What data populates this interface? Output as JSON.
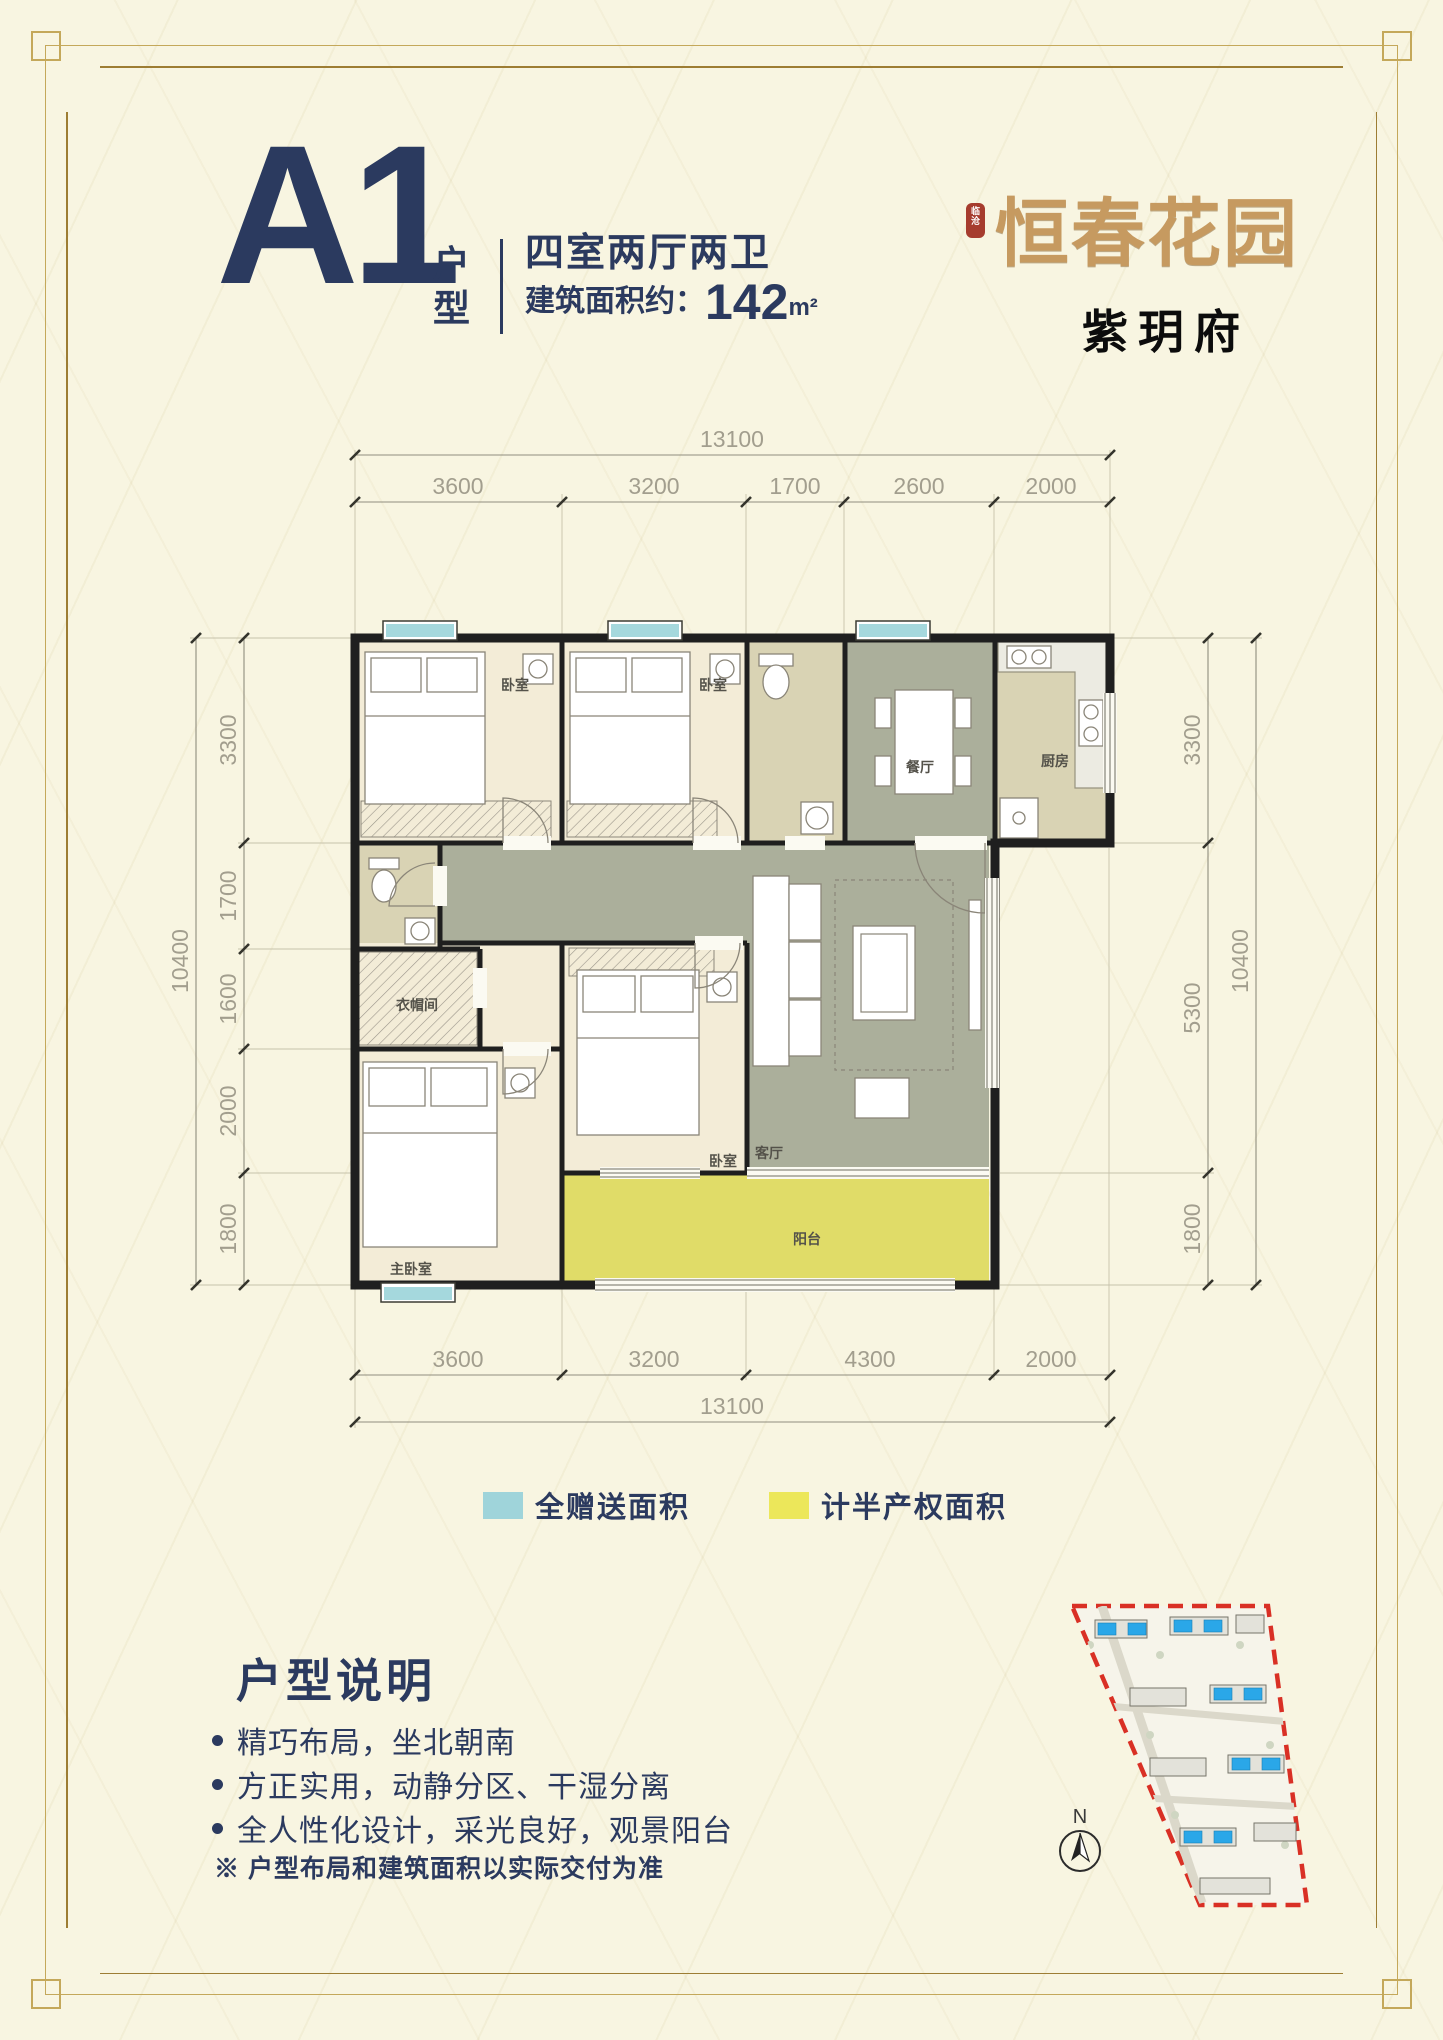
{
  "page": {
    "background": "#f8f5e1"
  },
  "header": {
    "plan_code": "A1",
    "plan_code_label": "户型",
    "spec": "四室两厅两卫",
    "area_label": "建筑面积约：",
    "area_value": "142",
    "area_unit": "m²"
  },
  "brand": {
    "seal": "临沧",
    "name": "恒春花园",
    "subname": "紫玥府"
  },
  "plan": {
    "dims": {
      "top_total": "13100",
      "top": [
        "3600",
        "3200",
        "1700",
        "2600",
        "2000"
      ],
      "left_total": "10400",
      "left": [
        "3300",
        "1700",
        "1600",
        "2000",
        "1800"
      ],
      "right_total": "10400",
      "right": [
        "3300",
        "5300",
        "1800"
      ],
      "bottom": [
        "3600",
        "3200",
        "4300",
        "2000"
      ],
      "bottom_total": "13100"
    },
    "rooms": {
      "bedroom": "卧室",
      "dining": "餐厅",
      "kitchen": "厨房",
      "closet": "衣帽间",
      "living": "客厅",
      "master": "主卧室",
      "balcony": "阳台"
    }
  },
  "legend": {
    "items": [
      {
        "label": "全赠送面积",
        "color": "#9fd4da"
      },
      {
        "label": "计半产权面积",
        "color": "#ece75a"
      }
    ]
  },
  "notes": {
    "title": "户型说明",
    "bullets": [
      "精巧布局，坐北朝南",
      "方正实用，动静分区、干湿分离",
      "全人性化设计，采光良好，观景阳台"
    ],
    "disclaimer": "※ 户型布局和建筑面积以实际交付为准"
  },
  "siteplan": {
    "north": "N"
  },
  "colors": {
    "navy": "#2b3a5f",
    "gold_frame": "#c4a85a",
    "gold_frame_inner": "#9d7d33",
    "logo_tan": "#c69a60",
    "seal_red": "#a63c2e",
    "wall": "#1f1f1f",
    "room_cream": "#f3ecd7",
    "room_khaki": "#d9d3b4",
    "room_green": "#abaf9b",
    "balcony_yellow": "#e0dc68",
    "bay_cyan": "#a5d8dd",
    "site_boundary_red": "#d93025",
    "site_building_blue": "#2aa7e8"
  }
}
